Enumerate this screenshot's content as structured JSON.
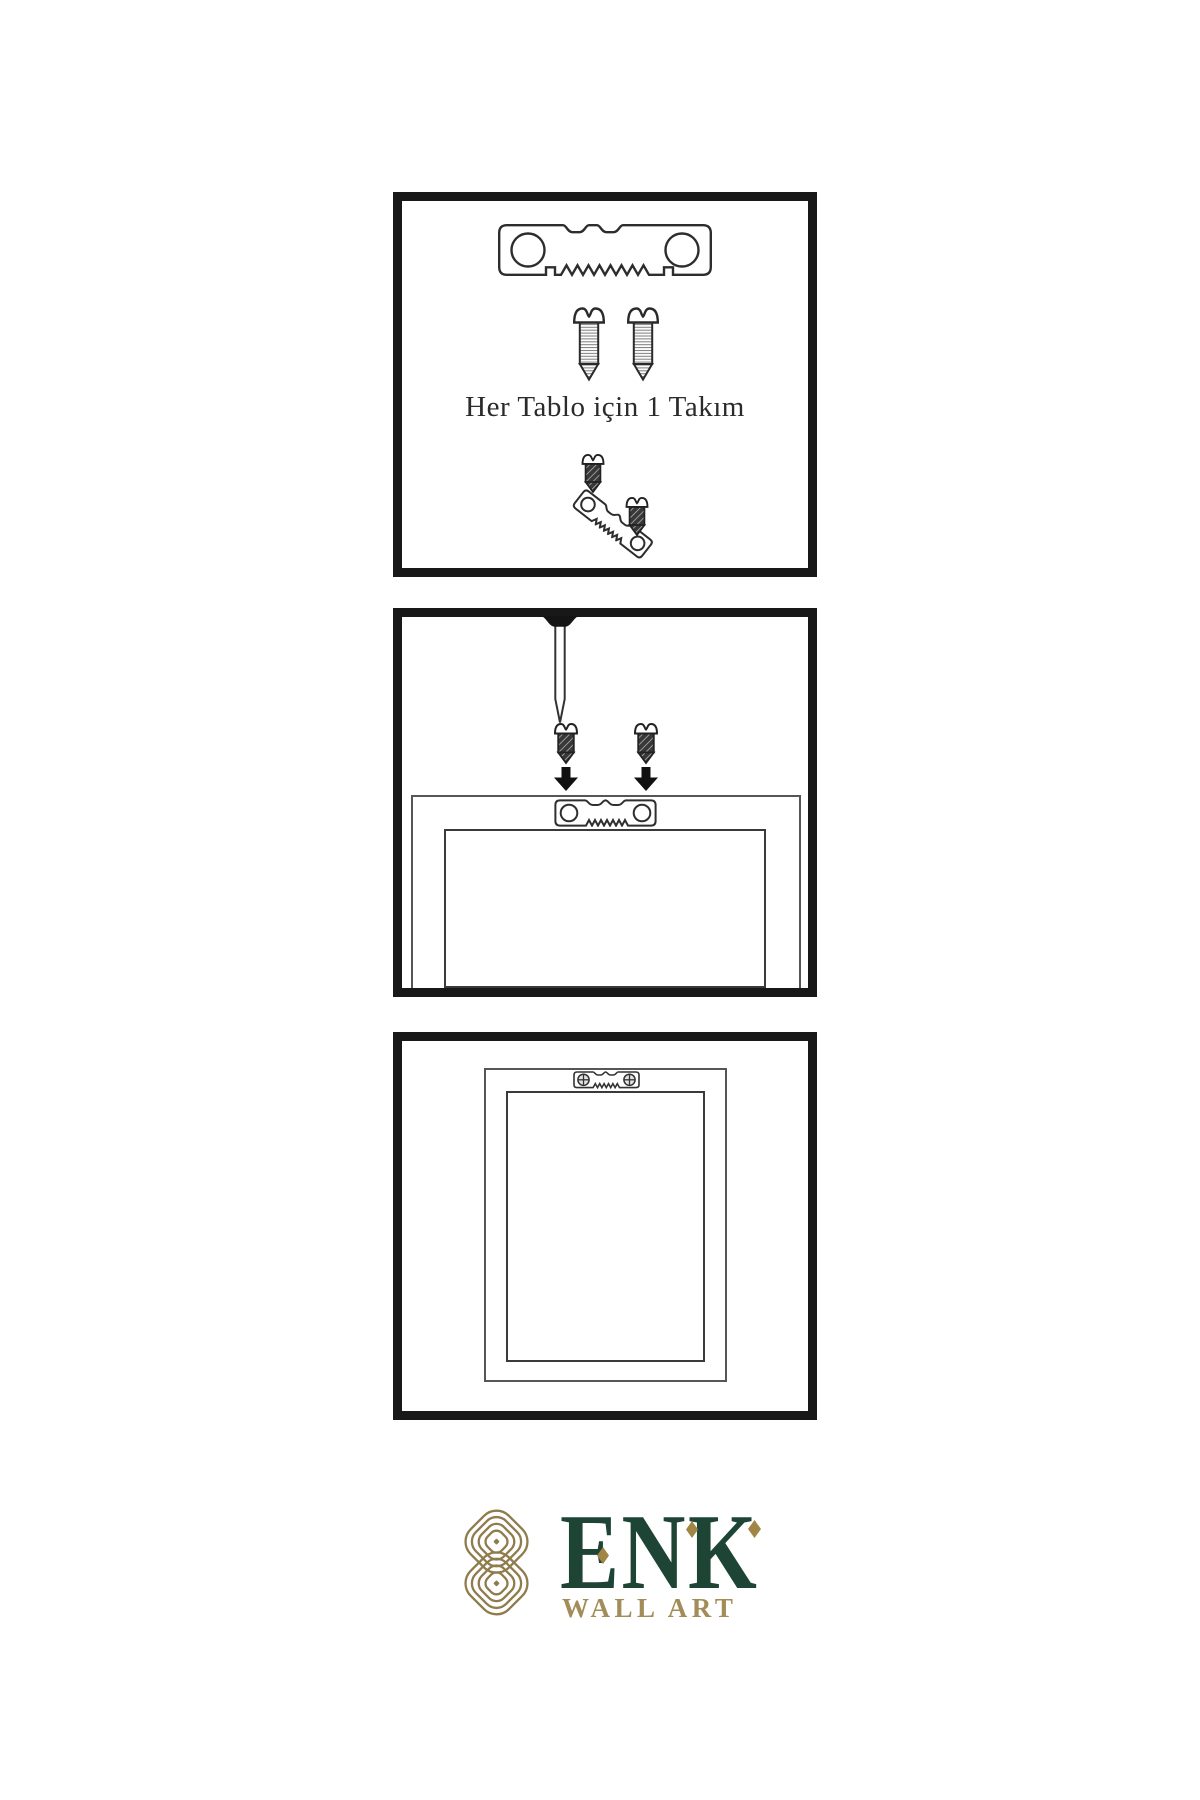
{
  "page": {
    "background": "#ffffff",
    "line_color": "#2d2d2d",
    "panel_border_color": "#181818"
  },
  "steps": [
    {
      "caption": "Her Tablo için 1 Takım",
      "contents": [
        "sawtooth-hanger-plate",
        "screw",
        "screw",
        "angled-hanger-with-two-screws"
      ]
    },
    {
      "caption": "",
      "contents": [
        "wall-nail",
        "screw",
        "screw",
        "arrow-down",
        "arrow-down",
        "frame-back-with-sawtooth-hanger"
      ]
    },
    {
      "caption": "",
      "contents": [
        "hung-frame-with-installed-sawtooth-hanger"
      ]
    }
  ],
  "logo": {
    "brand": "ENK",
    "subtitle": "WALL ART",
    "brand_color": "#1d4434",
    "knot_gold": "#8f7b4b",
    "diamond_gold": "#a08545",
    "subtitle_gold": "#a28d58"
  }
}
